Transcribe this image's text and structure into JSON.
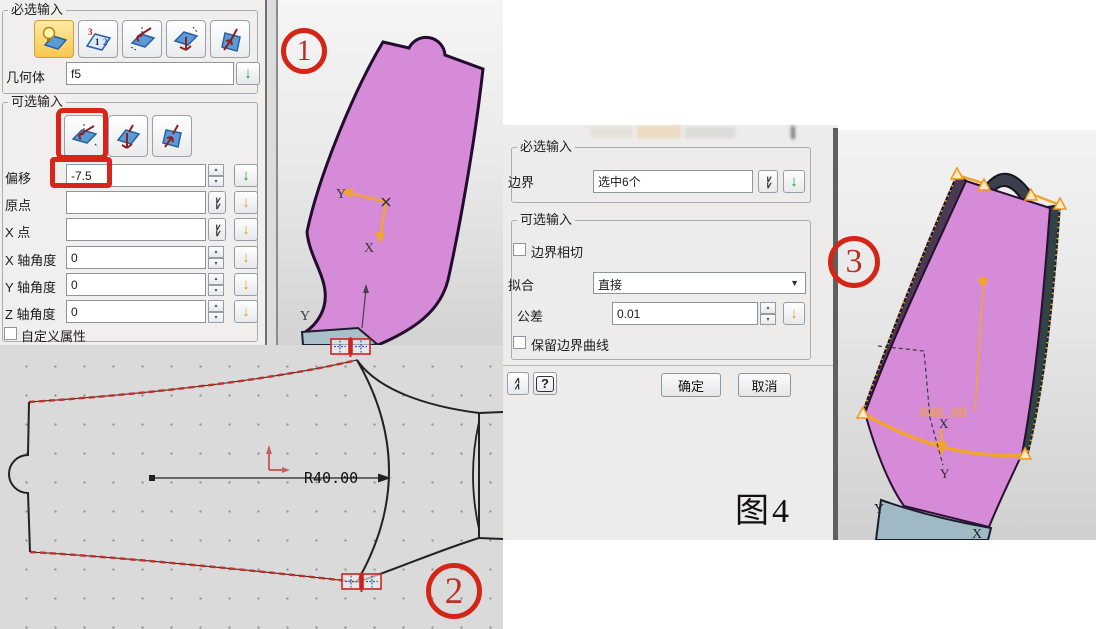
{
  "dialog1": {
    "required_group": "必选输入",
    "geometry": {
      "label": "几何体",
      "value": "f5"
    },
    "optional_group": "可选输入",
    "offset": {
      "label": "偏移",
      "value": "-7.5"
    },
    "origin": {
      "label": "原点",
      "value": ""
    },
    "x_point": {
      "label": "X 点",
      "value": ""
    },
    "x_angle": {
      "label": "X 轴角度",
      "value": "0"
    },
    "y_angle": {
      "label": "Y 轴角度",
      "value": "0"
    },
    "z_angle": {
      "label": "Z 轴角度",
      "value": "0"
    },
    "custom_attr_label": "自定义属性"
  },
  "dialog2": {
    "required_group": "必选输入",
    "boundary": {
      "label": "边界",
      "value": "选中6个"
    },
    "optional_group": "可选输入",
    "boundary_tangent_label": "边界相切",
    "fit": {
      "label": "拟合",
      "value": "直接"
    },
    "tolerance": {
      "label": "公差",
      "value": "0.01"
    },
    "keep_boundary_label": "保留边界曲线",
    "ok_label": "确定",
    "cancel_label": "取消",
    "figure_caption": "图4"
  },
  "badges": {
    "one": "1",
    "two": "2",
    "three": "3"
  },
  "sketch": {
    "radius_dim": "R40.00"
  },
  "view1": {
    "axis_x": "X",
    "axis_y": "Y",
    "axis_y2": "Y"
  },
  "view3": {
    "radius_dim": "R40.00",
    "axis_x": "X",
    "axis_y": "Y",
    "base_x": "X",
    "base_y": "Y"
  },
  "icons": {
    "down_arrow": "↓",
    "chevron": "∨",
    "dropdown_arrow": "▼",
    "spinner_up": "▴",
    "spinner_down": "▾",
    "help": "?",
    "n3": "3",
    "n1": "1",
    "n2": "2"
  },
  "colors": {
    "annotation_red": "#d9241a",
    "blade_pink": "#d58bd8",
    "highlight_orange": "#f2a52e",
    "confirm_green": "#199638",
    "apply_yellow": "#dd9f26"
  }
}
